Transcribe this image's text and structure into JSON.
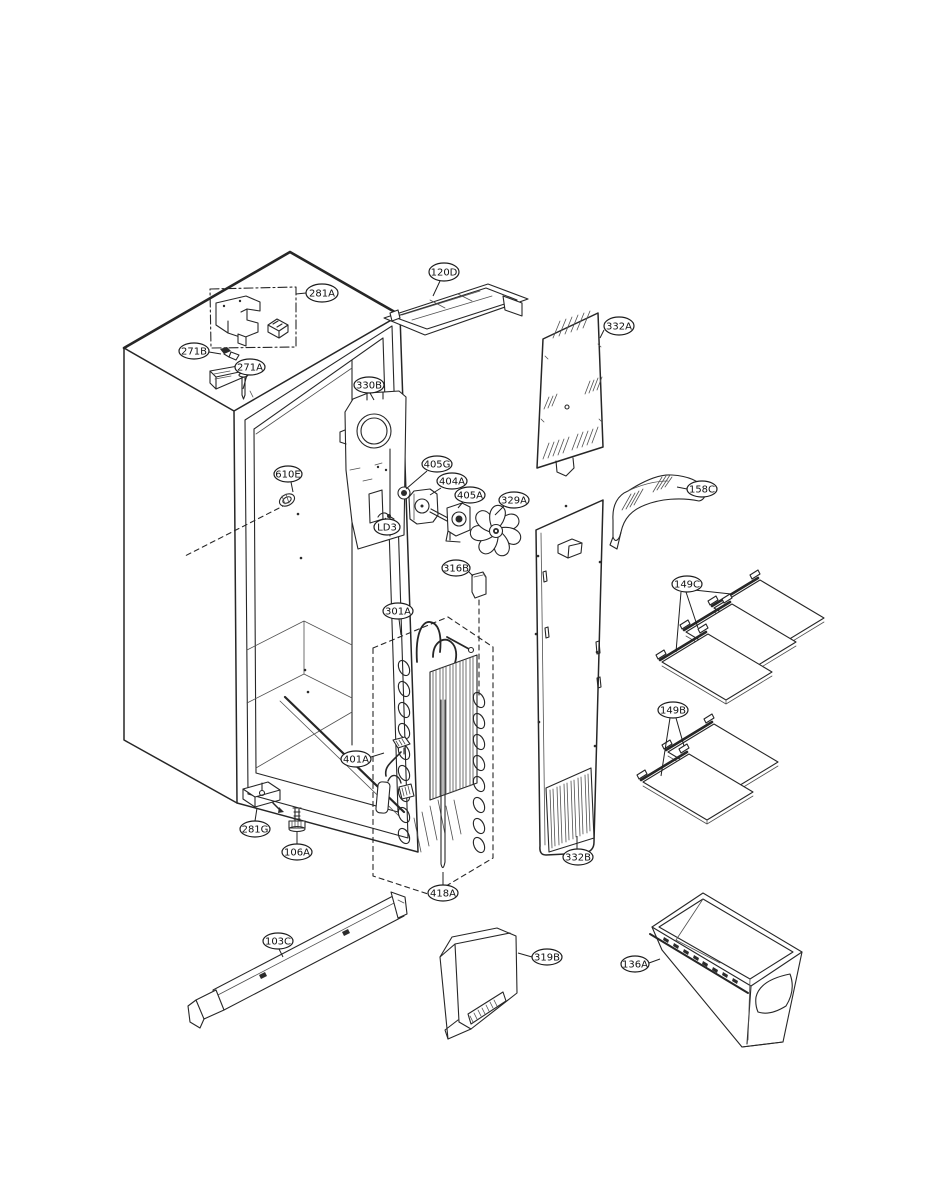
{
  "diagram": {
    "kind": "exploded-parts-diagram",
    "background_color": "#ffffff",
    "line_color": "#262626",
    "balloon_stroke_color": "#1c1c1c",
    "balloon_text_color": "#0f0f0f",
    "callouts": [
      {
        "id": "281A",
        "cx": 322,
        "cy": 293,
        "rx": 16,
        "ry": 9,
        "leaders": [
          [
            306,
            293,
            296,
            294
          ]
        ]
      },
      {
        "id": "271B",
        "cx": 194,
        "cy": 351,
        "rx": 15,
        "ry": 8,
        "leaders": [
          [
            209,
            352,
            221,
            354
          ]
        ]
      },
      {
        "id": "271A",
        "cx": 250,
        "cy": 367,
        "rx": 15,
        "ry": 8,
        "leaders": [
          [
            247,
            375,
            243,
            389
          ]
        ]
      },
      {
        "id": "120D",
        "cx": 444,
        "cy": 272,
        "rx": 15,
        "ry": 9,
        "leaders": [
          [
            440,
            281,
            433,
            296
          ]
        ]
      },
      {
        "id": "332A",
        "cx": 619,
        "cy": 326,
        "rx": 15,
        "ry": 9,
        "leaders": [
          [
            604,
            330,
            600,
            338
          ]
        ]
      },
      {
        "id": "330B",
        "cx": 369,
        "cy": 385,
        "rx": 15,
        "ry": 8,
        "leaders": [
          [
            370,
            393,
            374,
            400
          ]
        ]
      },
      {
        "id": "610E",
        "cx": 288,
        "cy": 474,
        "rx": 14,
        "ry": 8,
        "leaders": [
          [
            291,
            482,
            293,
            492
          ]
        ]
      },
      {
        "id": "405G",
        "cx": 437,
        "cy": 464,
        "rx": 15,
        "ry": 8,
        "leaders": [
          [
            427,
            471,
            406,
            489
          ]
        ]
      },
      {
        "id": "404A",
        "cx": 452,
        "cy": 481,
        "rx": 15,
        "ry": 8,
        "leaders": [
          [
            441,
            488,
            430,
            495
          ]
        ]
      },
      {
        "id": "405A",
        "cx": 470,
        "cy": 495,
        "rx": 15,
        "ry": 8,
        "leaders": [
          [
            463,
            502,
            458,
            508
          ]
        ]
      },
      {
        "id": "329A",
        "cx": 514,
        "cy": 500,
        "rx": 15,
        "ry": 8,
        "leaders": [
          [
            504,
            506,
            495,
            515
          ]
        ]
      },
      {
        "id": "LD3",
        "cx": 387,
        "cy": 527,
        "rx": 13,
        "ry": 8,
        "leaders": [
          [
            386,
            519,
            385,
            518
          ]
        ]
      },
      {
        "id": "316B",
        "cx": 456,
        "cy": 568,
        "rx": 14,
        "ry": 8,
        "leaders": [
          [
            469,
            572,
            473,
            576
          ]
        ]
      },
      {
        "id": "158C",
        "cx": 702,
        "cy": 489,
        "rx": 15,
        "ry": 8,
        "leaders": [
          [
            687,
            489,
            677,
            487
          ]
        ]
      },
      {
        "id": "149C",
        "cx": 687,
        "cy": 584,
        "rx": 15,
        "ry": 8,
        "leaders": [
          [
            694,
            590,
            731,
            594
          ],
          [
            686,
            592,
            698,
            628
          ],
          [
            681,
            592,
            676,
            652
          ]
        ]
      },
      {
        "id": "301A",
        "cx": 398,
        "cy": 611,
        "rx": 15,
        "ry": 8,
        "leaders": [
          [
            399,
            619,
            401,
            635
          ]
        ]
      },
      {
        "id": "149B",
        "cx": 673,
        "cy": 710,
        "rx": 15,
        "ry": 8,
        "leaders": [
          [
            676,
            718,
            684,
            746
          ],
          [
            670,
            718,
            661,
            776
          ]
        ]
      },
      {
        "id": "401A",
        "cx": 356,
        "cy": 759,
        "rx": 15,
        "ry": 8,
        "leaders": [
          [
            371,
            757,
            384,
            753
          ]
        ]
      },
      {
        "id": "281G",
        "cx": 255,
        "cy": 829,
        "rx": 15,
        "ry": 8,
        "leaders": [
          [
            255,
            821,
            257,
            808
          ]
        ]
      },
      {
        "id": "106A",
        "cx": 297,
        "cy": 852,
        "rx": 15,
        "ry": 8,
        "leaders": [
          [
            297,
            844,
            297,
            832
          ]
        ]
      },
      {
        "id": "332B",
        "cx": 578,
        "cy": 857,
        "rx": 15,
        "ry": 8,
        "leaders": [
          [
            577,
            849,
            577,
            836
          ]
        ]
      },
      {
        "id": "418A",
        "cx": 443,
        "cy": 893,
        "rx": 15,
        "ry": 8,
        "leaders": [
          [
            443,
            885,
            443,
            872
          ]
        ]
      },
      {
        "id": "103C",
        "cx": 278,
        "cy": 941,
        "rx": 15,
        "ry": 8,
        "leaders": [
          [
            279,
            949,
            283,
            957
          ]
        ]
      },
      {
        "id": "319B",
        "cx": 547,
        "cy": 957,
        "rx": 15,
        "ry": 8,
        "leaders": [
          [
            532,
            957,
            518,
            953
          ]
        ]
      },
      {
        "id": "136A",
        "cx": 635,
        "cy": 964,
        "rx": 14,
        "ry": 8,
        "leaders": [
          [
            649,
            963,
            660,
            959
          ]
        ]
      }
    ]
  }
}
